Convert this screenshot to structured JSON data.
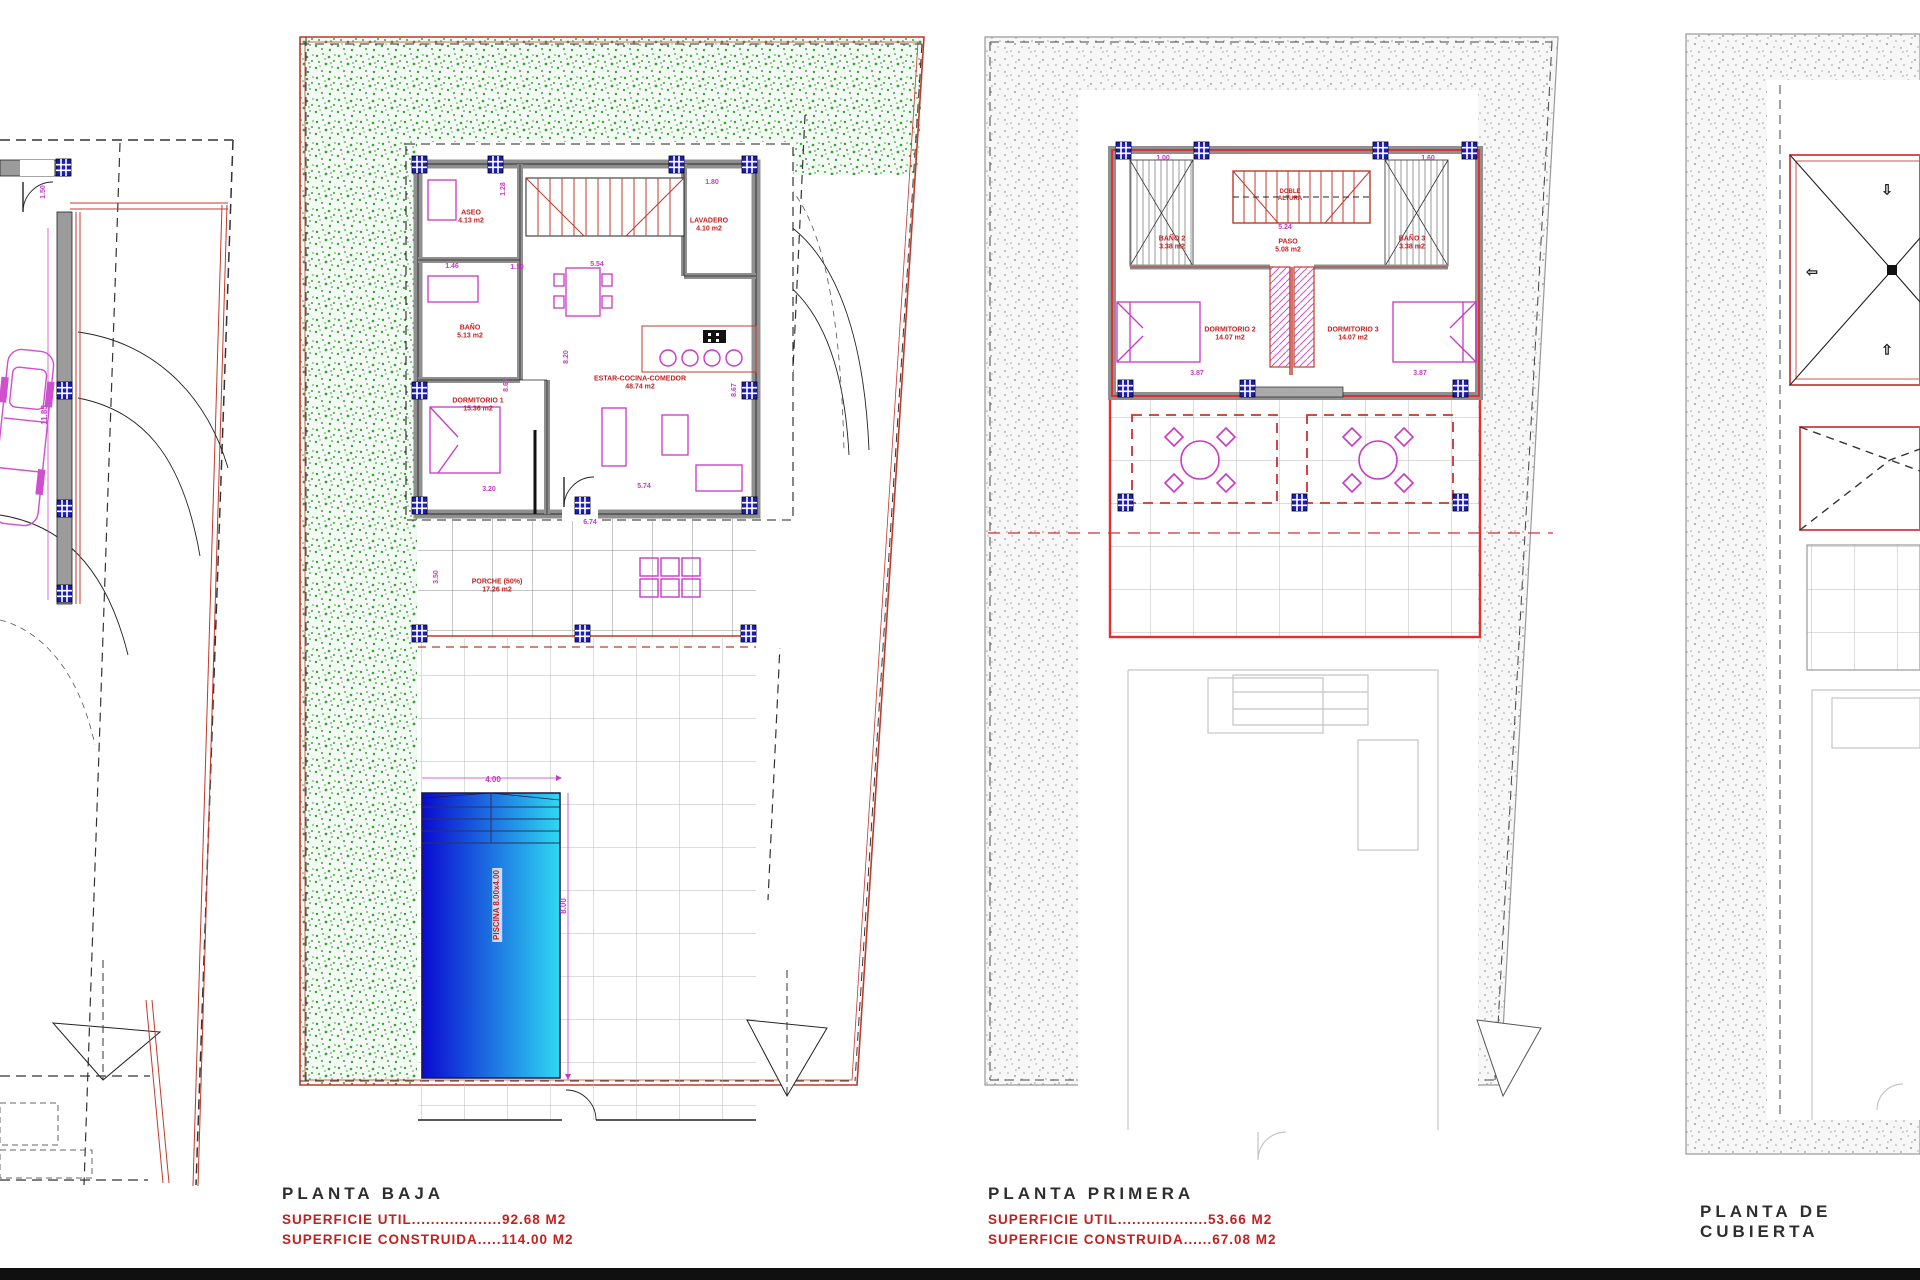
{
  "captions": {
    "planta_baja": {
      "title": "PLANTA BAJA",
      "util": "SUPERFICIE UTIL...................92.68 M2",
      "construida": "SUPERFICIE CONSTRUIDA.....114.00 M2"
    },
    "planta_primera": {
      "title": "PLANTA PRIMERA",
      "util": "SUPERFICIE UTIL...................53.66 M2",
      "construida": "SUPERFICIE CONSTRUIDA......67.08 M2"
    },
    "planta_cubierta": {
      "title": "PLANTA DE CUBIERTA"
    }
  },
  "colors": {
    "red": "#c41f1f",
    "magenta": "#c837c8",
    "blue": "#1c1cb8",
    "green": "#3aa23a",
    "pool_start": "#0a0ad0",
    "pool_end": "#2fd8f2",
    "wall_gray": "#8f8f8f",
    "black": "#222222"
  },
  "labels": [
    {
      "t": "1.50",
      "x": 44,
      "y": 192,
      "r": -90,
      "c": "#c837c8",
      "s": 7
    },
    {
      "t": "11.85",
      "x": 45,
      "y": 415,
      "r": -90,
      "c": "#c837c8",
      "s": 8
    },
    {
      "t": "ASEO\n4.13 m2",
      "x": 471,
      "y": 218,
      "c": "#c41f1f",
      "s": 7
    },
    {
      "t": "LAVADERO\n4.10 m2",
      "x": 709,
      "y": 226,
      "c": "#c41f1f",
      "s": 7
    },
    {
      "t": "BAÑO\n5.13 m2",
      "x": 470,
      "y": 333,
      "c": "#c41f1f",
      "s": 7
    },
    {
      "t": "DORMITORIO 1\n15.36 m2",
      "x": 478,
      "y": 406,
      "c": "#c41f1f",
      "s": 7
    },
    {
      "t": "ESTAR-COCINA-COMEDOR\n48.74 m2",
      "x": 640,
      "y": 384,
      "c": "#c41f1f",
      "s": 7
    },
    {
      "t": "PORCHE (50%)\n17.26 m2",
      "x": 497,
      "y": 587,
      "c": "#c41f1f",
      "s": 7
    },
    {
      "t": "PISCINA 8.00x4.00",
      "x": 497,
      "y": 905,
      "r": -90,
      "c": "#c41f1f",
      "s": 8,
      "bg": 1
    },
    {
      "t": "1.28",
      "x": 504,
      "y": 189,
      "r": -90,
      "c": "#c837c8",
      "s": 7
    },
    {
      "t": "1.46",
      "x": 452,
      "y": 267,
      "c": "#c837c8",
      "s": 7
    },
    {
      "t": "1.10",
      "x": 517,
      "y": 268,
      "c": "#c837c8",
      "s": 7
    },
    {
      "t": "5.54",
      "x": 597,
      "y": 265,
      "c": "#c837c8",
      "s": 7
    },
    {
      "t": "1.80",
      "x": 712,
      "y": 183,
      "c": "#c837c8",
      "s": 7
    },
    {
      "t": "8.20",
      "x": 567,
      "y": 357,
      "r": -90,
      "c": "#c837c8",
      "s": 7
    },
    {
      "t": "8.67",
      "x": 507,
      "y": 385,
      "r": -90,
      "c": "#c837c8",
      "s": 7
    },
    {
      "t": "8.67",
      "x": 735,
      "y": 390,
      "r": -90,
      "c": "#c837c8",
      "s": 7
    },
    {
      "t": "3.20",
      "x": 489,
      "y": 490,
      "c": "#c837c8",
      "s": 7
    },
    {
      "t": "5.74",
      "x": 644,
      "y": 487,
      "c": "#c837c8",
      "s": 7
    },
    {
      "t": "6.74",
      "x": 590,
      "y": 523,
      "c": "#c837c8",
      "s": 7
    },
    {
      "t": "3.50",
      "x": 437,
      "y": 577,
      "r": -90,
      "c": "#c837c8",
      "s": 7
    },
    {
      "t": "4.00",
      "x": 493,
      "y": 780,
      "c": "#c837c8",
      "s": 8
    },
    {
      "t": "8.00",
      "x": 564,
      "y": 906,
      "r": -90,
      "c": "#c837c8",
      "s": 8
    },
    {
      "t": "1.00",
      "x": 1163,
      "y": 159,
      "c": "#c837c8",
      "s": 7
    },
    {
      "t": "1.60",
      "x": 1428,
      "y": 159,
      "c": "#c837c8",
      "s": 7
    },
    {
      "t": "DOBLE\nALTURA",
      "x": 1290,
      "y": 196,
      "c": "#c41f1f",
      "s": 6
    },
    {
      "t": "5.24",
      "x": 1285,
      "y": 228,
      "c": "#c837c8",
      "s": 7
    },
    {
      "t": "PASO\n5.08 m2",
      "x": 1288,
      "y": 247,
      "c": "#c41f1f",
      "s": 7
    },
    {
      "t": "BAÑO 2\n3.38 m2",
      "x": 1172,
      "y": 244,
      "c": "#c41f1f",
      "s": 7
    },
    {
      "t": "BAÑO 3\n3.38 m2",
      "x": 1412,
      "y": 244,
      "c": "#c41f1f",
      "s": 7
    },
    {
      "t": "DORMITORIO 2\n14.07 m2",
      "x": 1230,
      "y": 335,
      "c": "#c41f1f",
      "s": 7
    },
    {
      "t": "DORMITORIO 3\n14.07 m2",
      "x": 1353,
      "y": 335,
      "c": "#c41f1f",
      "s": 7
    },
    {
      "t": "3.87",
      "x": 1197,
      "y": 374,
      "c": "#c837c8",
      "s": 7
    },
    {
      "t": "3.87",
      "x": 1420,
      "y": 374,
      "c": "#c837c8",
      "s": 7
    },
    {
      "t": "⇩",
      "x": 1887,
      "y": 190,
      "c": "#222222",
      "s": 14,
      "n": "pitch-arrow-down-icon"
    },
    {
      "t": "⇦",
      "x": 1812,
      "y": 272,
      "c": "#222222",
      "s": 14,
      "n": "pitch-arrow-left-icon"
    },
    {
      "t": "⇧",
      "x": 1887,
      "y": 350,
      "c": "#222222",
      "s": 14,
      "n": "pitch-arrow-up-icon"
    }
  ]
}
